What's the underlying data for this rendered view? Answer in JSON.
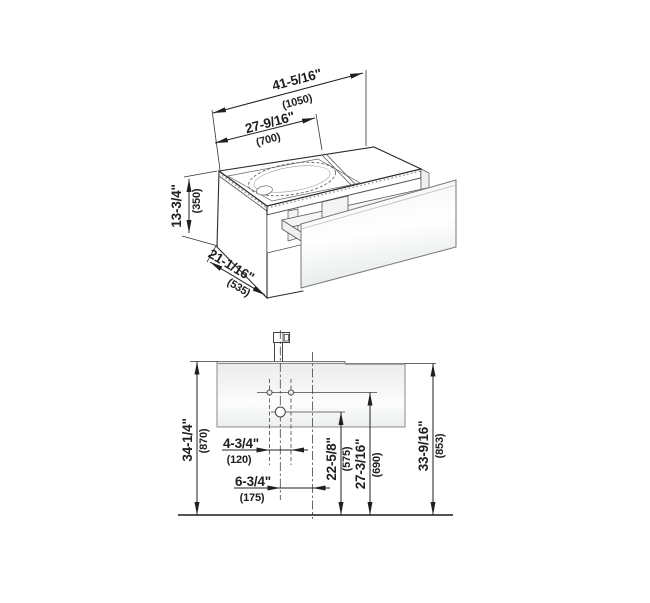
{
  "views": {
    "isometric": {
      "dims": {
        "total_width_in": "41-5/16\"",
        "total_width_mm": "(1050)",
        "basin_width_in": "27-9/16\"",
        "basin_width_mm": "(700)",
        "height_in": "13-3/4\"",
        "height_mm": "(350)",
        "depth_in": "21-1/16\"",
        "depth_mm": "(535)"
      }
    },
    "front": {
      "dims": {
        "tap_hole_spacing_in": "4-3/4\"",
        "tap_hole_spacing_mm": "(120)",
        "center_offset_in": "6-3/4\"",
        "center_offset_mm": "(175)",
        "drain_height_in": "22-5/8\"",
        "drain_height_mm": "(575)",
        "tap_hole_height_in": "27-3/16\"",
        "tap_hole_height_mm": "(690)",
        "basin_top_height_in": "34-1/4\"",
        "basin_top_height_mm": "(870)",
        "cabinet_top_height_in": "33-9/16\"",
        "cabinet_top_height_mm": "(853)"
      }
    }
  },
  "colors": {
    "line": "#2b2b2b",
    "dimension_text": "#1f1f1f",
    "cabinet_fill": "#f3f4f4",
    "glass_highlight": "#fbfcfc",
    "glass_shadow": "#e6eaea",
    "background": "#ffffff"
  }
}
